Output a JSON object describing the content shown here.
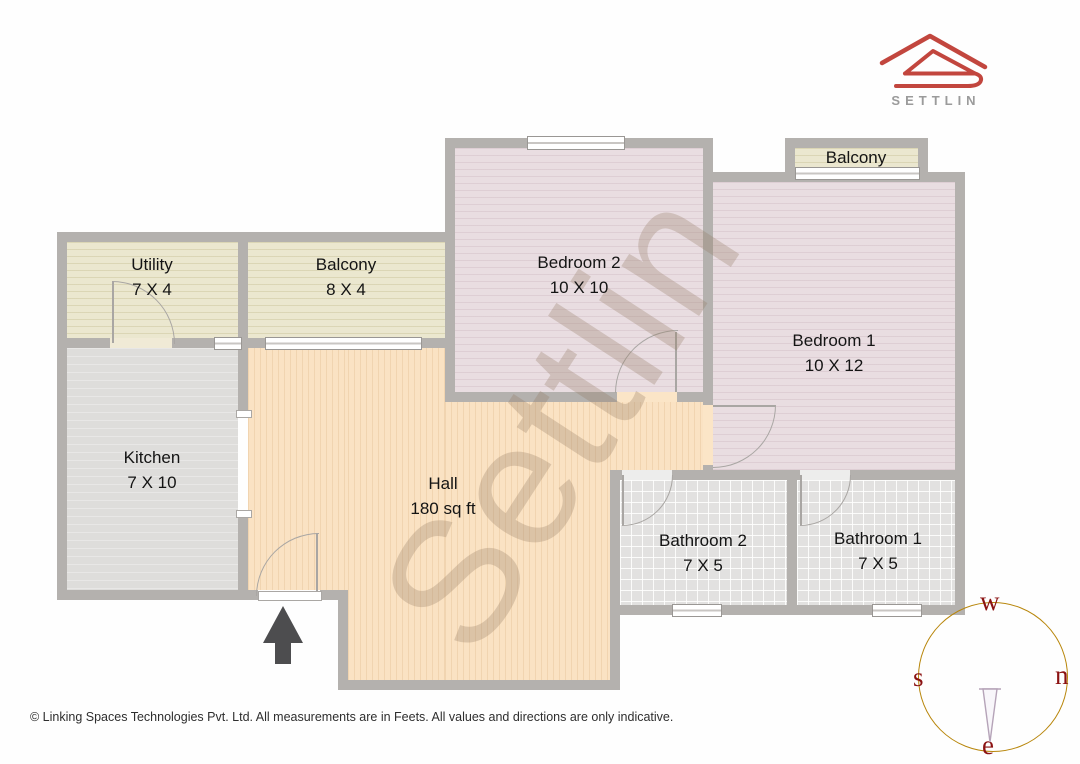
{
  "brand": {
    "name": "SETTLIN"
  },
  "watermark": {
    "text": "Settlin"
  },
  "rooms": [
    {
      "id": "utility",
      "label": "Utility",
      "dims": "7 X 4"
    },
    {
      "id": "balcony-west",
      "label": "Balcony",
      "dims": "8 X 4"
    },
    {
      "id": "kitchen",
      "label": "Kitchen",
      "dims": "7 X 10"
    },
    {
      "id": "hall",
      "label": "Hall",
      "dims": "180 sq ft"
    },
    {
      "id": "bedroom-2",
      "label": "Bedroom 2",
      "dims": "10 X 10"
    },
    {
      "id": "bedroom-1",
      "label": "Bedroom 1",
      "dims": "10 X 12"
    },
    {
      "id": "balcony-north",
      "label": "Balcony"
    },
    {
      "id": "bathroom-2",
      "label": "Bathroom 2",
      "dims": "7 X 5"
    },
    {
      "id": "bathroom-1",
      "label": "Bathroom 1",
      "dims": "7 X 5"
    }
  ],
  "compass": {
    "top": "w",
    "right": "n",
    "left": "s",
    "bottom": "e"
  },
  "footer": {
    "copyright": "© Linking Spaces Technologies Pvt. Ltd. All measurements are in Feets. All values and directions are only indicative."
  },
  "colors": {
    "wall": "#b4b1ae",
    "hall": "#fae2c3",
    "bedroom": "#e9dde1",
    "balcony_utility": "#ebe7cf",
    "kitchen": "#dedddb",
    "bathroom": "#e2e1e0",
    "logo_red": "#c2463e",
    "brand_gray": "#9b9b9b",
    "compass_ring": "#b8860b",
    "compass_letters": "#8b1212",
    "arrow": "#4d4d4f"
  }
}
